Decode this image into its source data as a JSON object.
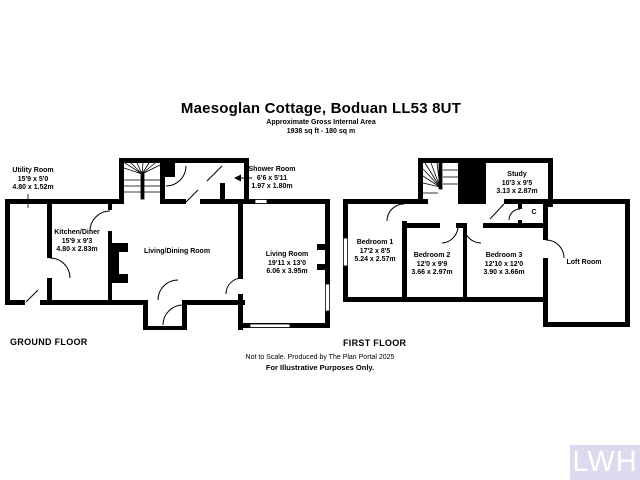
{
  "header": {
    "title": "Maesoglan Cottage, Boduan LL53 8UT",
    "subtitle1": "Approximate Gross Internal Area",
    "subtitle2": "1938 sq ft - 180 sq m"
  },
  "ground_floor": {
    "label": "GROUND FLOOR",
    "rooms": [
      {
        "name": "Utility Room",
        "imperial": "15'9 x 5'0",
        "metric": "4.80 x 1.52m"
      },
      {
        "name": "Kitchen/Diner",
        "imperial": "15'9 x 9'3",
        "metric": "4.80 x 2.83m"
      },
      {
        "name": "Living/Dining Room",
        "imperial": "",
        "metric": ""
      },
      {
        "name": "Shower Room",
        "imperial": "6'6 x 5'11",
        "metric": "1.97 x 1.80m"
      },
      {
        "name": "Living Room",
        "imperial": "19'11 x 13'0",
        "metric": "6.06 x 3.95m"
      }
    ]
  },
  "first_floor": {
    "label": "FIRST FLOOR",
    "rooms": [
      {
        "name": "Bedroom 1",
        "imperial": "17'2 x 8'5",
        "metric": "5.24 x 2.57m"
      },
      {
        "name": "Bedroom 2",
        "imperial": "12'0 x 9'9",
        "metric": "3.66 x 2.97m"
      },
      {
        "name": "Bedroom 3",
        "imperial": "12'10 x 12'0",
        "metric": "3.90 x 3.66m"
      },
      {
        "name": "Study",
        "imperial": "10'3 x 9'5",
        "metric": "3.13 x 2.87m"
      },
      {
        "name": "Loft Room",
        "imperial": "",
        "metric": ""
      },
      {
        "name": "C",
        "imperial": "",
        "metric": ""
      }
    ]
  },
  "footer": {
    "line1": "Not to Scale. Produced by The Plan Portal 2025",
    "line2": "For Illustrative Purposes Only."
  },
  "watermark": {
    "text": "LWH",
    "background": "#ded9ee",
    "color": "#ffffff"
  },
  "colors": {
    "wall": "#000000",
    "background": "#ffffff"
  }
}
